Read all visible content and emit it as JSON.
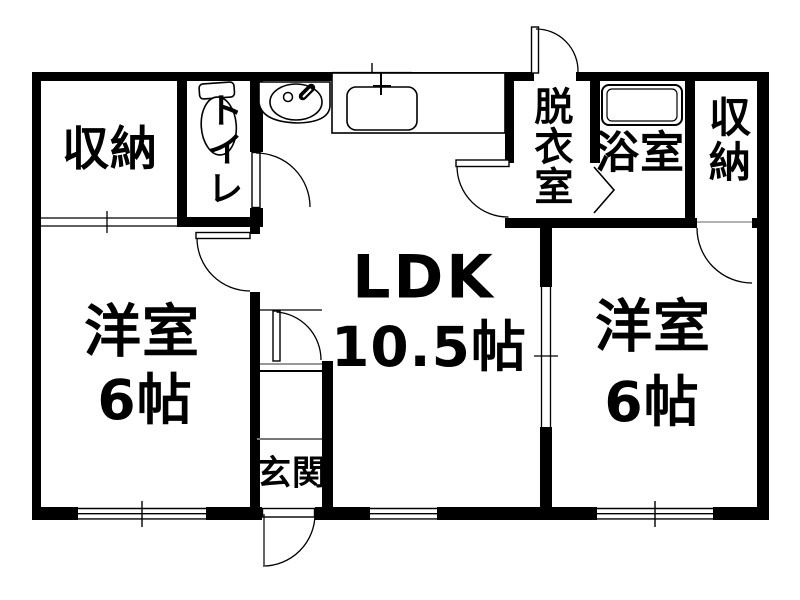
{
  "page": {
    "background": "#ffffff"
  },
  "colors": {
    "wall": "#000000",
    "line": "#000000",
    "muted_line": "#8a8a8a"
  },
  "rooms": {
    "closet_tl": {
      "label": "収納"
    },
    "toilet": {
      "label": "トイレ"
    },
    "ldk": {
      "label": "LDK",
      "area": "10.5帖"
    },
    "dressing": {
      "label": "脱衣室"
    },
    "bath": {
      "label": "浴室"
    },
    "closet_tr": {
      "label": "収納"
    },
    "west_left": {
      "label": "洋室",
      "area": "6帖"
    },
    "west_right": {
      "label": "洋室",
      "area": "6帖"
    },
    "genkan": {
      "label": "玄関"
    }
  },
  "fixtures": {
    "toilet": "toilet-icon",
    "washbasin": "washbasin-icon",
    "kitchen_sink": "kitchen-sink-icon",
    "bathtub": "bathtub-icon"
  }
}
